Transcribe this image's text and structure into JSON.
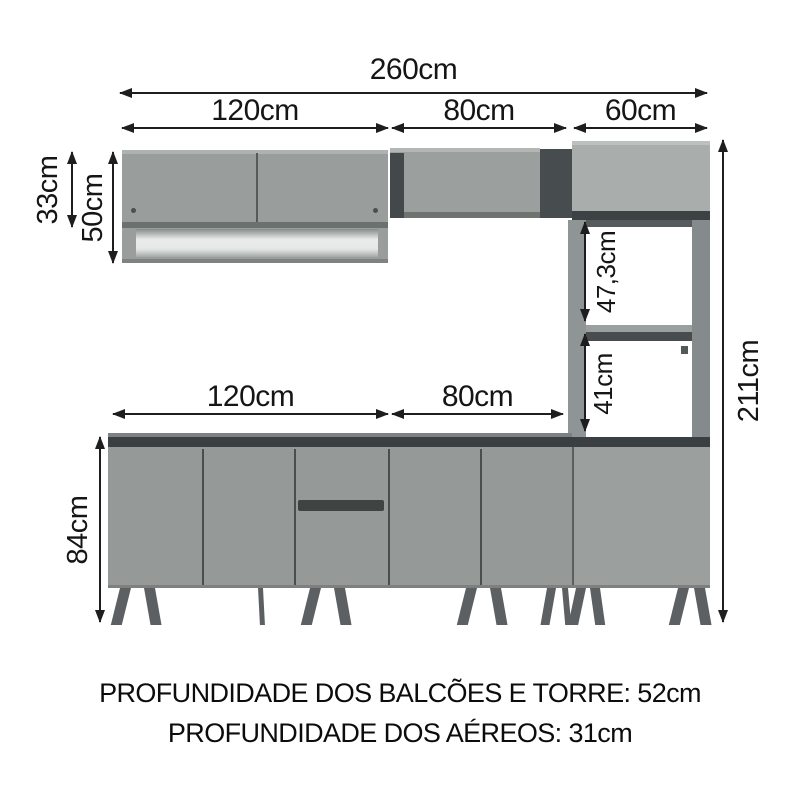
{
  "dims": {
    "w_total": "260cm",
    "w_aereo_1": "120cm",
    "w_aereo_2": "80cm",
    "w_aereo_3": "60cm",
    "w_balcao_1": "120cm",
    "w_balcao_2": "80cm",
    "h_aereo_door": "33cm",
    "h_aereo_total": "50cm",
    "h_balcao": "84cm",
    "h_tower_niche_1": "47,3cm",
    "h_tower_niche_2": "41cm",
    "h_total": "211cm"
  },
  "notes": {
    "depth_base_tower": "PROFUNDIDADE DOS BALCÕES E TORRE: 52cm",
    "depth_wall": "PROFUNDIDADE DOS AÉREOS: 31cm"
  },
  "colors": {
    "door_gray": "#969b99",
    "door_light_gray": "#a9adab",
    "top_sheen": "#b7bbb9",
    "dark_band": "#3d4245",
    "counter_dark": "#3a3f42",
    "frame_gray": "#8f9494",
    "shadow_gray": "#474c4e",
    "leg_gray": "#5c6063",
    "niche_white": "#edf0ef",
    "line_black": "#1e1e1e"
  }
}
